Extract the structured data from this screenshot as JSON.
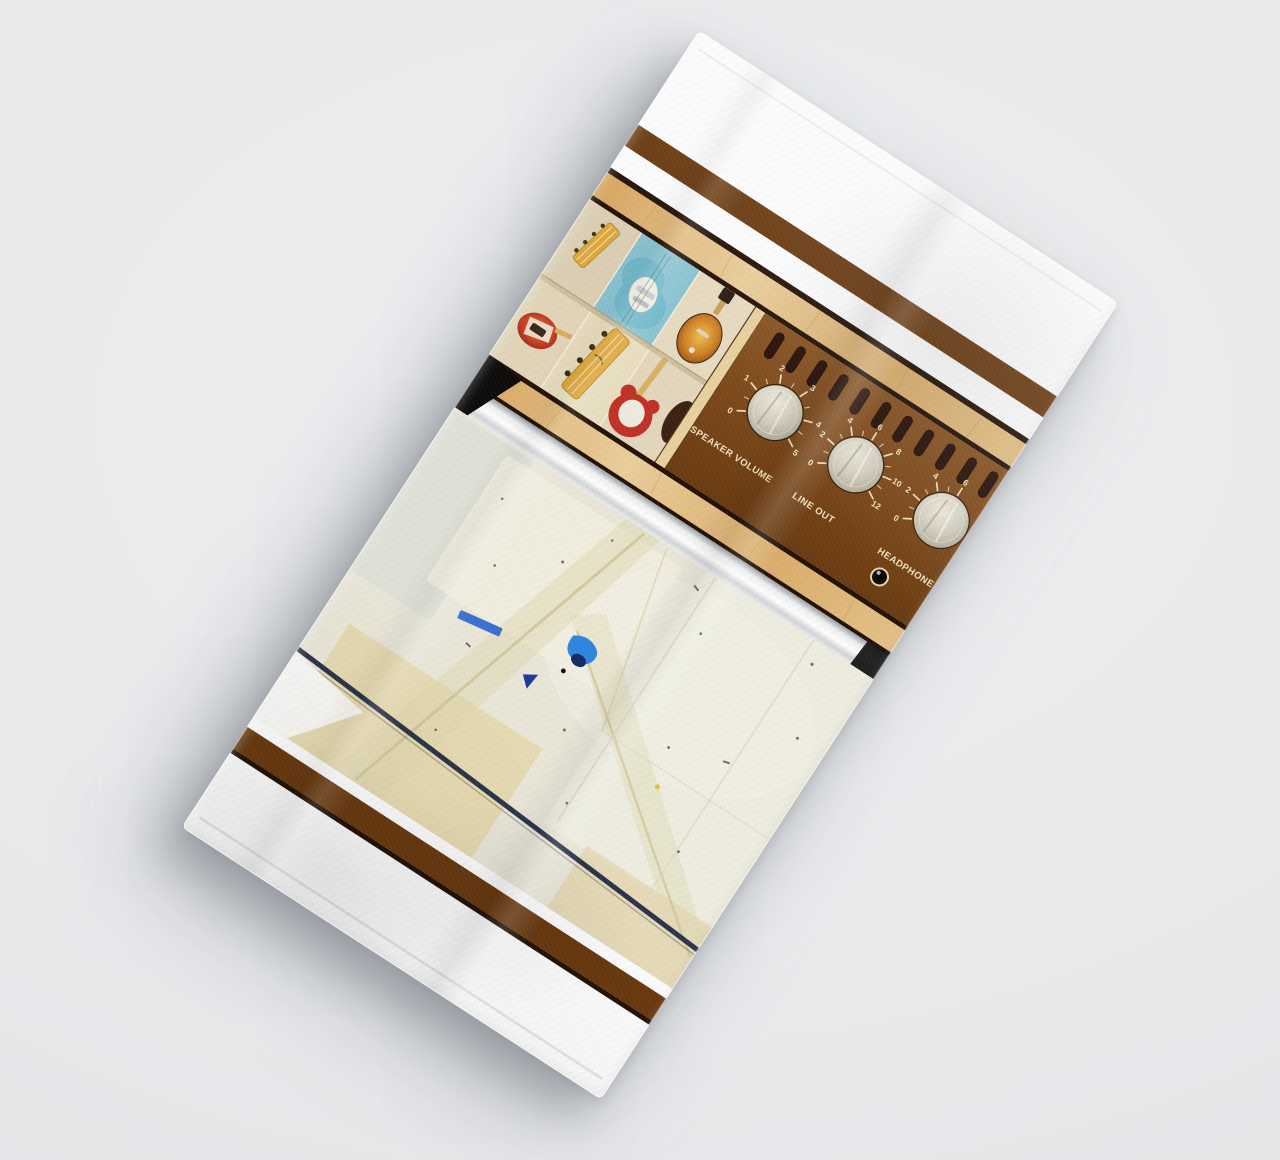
{
  "scene": {
    "background_color": "#e8e9eb",
    "description": "Product mockup photograph: white towel rotated on a light gray surface, printed with a vintage guitar-amplifier design"
  },
  "towel": {
    "rotation_deg": 33,
    "base_color": "#fdfdfd",
    "print": {
      "stripes": {
        "brown": "#6a3a10",
        "tan_wood": "#ddb172",
        "dark_line": "#241205",
        "white": "#ffffff"
      },
      "guitar_wall": {
        "description": "photo collage of electric guitars hanging on a shop wall",
        "wall_color": "#e6d9c0",
        "blue_tile_color": "#8cc5d4"
      },
      "amp_panel": {
        "background_color": "#7a4719",
        "text_color": "#f2e4c2",
        "vent_slot_count": 11,
        "knobs": [
          {
            "label": "SPEAKER VOLUME",
            "ticks": [
              "0",
              "1",
              "2",
              "3",
              "4",
              "5"
            ]
          },
          {
            "label": "LINE OUT",
            "ticks": [
              "0",
              "2",
              "4",
              "6",
              "8",
              "10",
              "12"
            ]
          },
          {
            "label": "HEADPHONE",
            "ticks": [
              "0",
              "2",
              "4",
              "6"
            ]
          }
        ]
      },
      "chrome_band_color": "#eef0f1",
      "washed_panel": {
        "description": "faded pale abstract photo with crossing tape lines, blue paint specks and a dark cable line",
        "base_color": "#ebe8da",
        "cable_line_color": "#222b45",
        "blue_accent": "#2f86e0"
      }
    }
  }
}
